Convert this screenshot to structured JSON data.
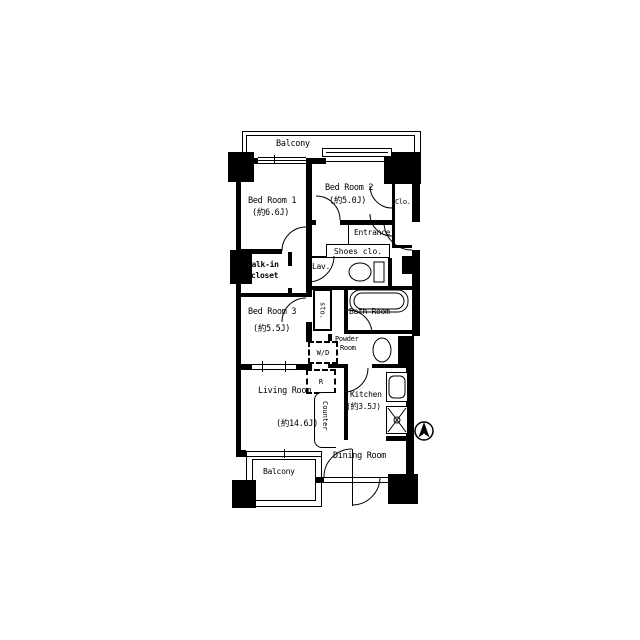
{
  "colors": {
    "walls": "#000000",
    "background": "#ffffff"
  },
  "floorplan": {
    "balcony_top": {
      "label": "Balcony"
    },
    "bedroom1": {
      "name": "Bed Room 1",
      "size": "(約6.6J)"
    },
    "bedroom2": {
      "name": "Bed Room 2",
      "size": "(約5.0J)"
    },
    "closet2": {
      "label": "Clo."
    },
    "entrance": {
      "label": "Entrance"
    },
    "shoes_closet": {
      "label": "Shoes clo."
    },
    "lavatory": {
      "label": "Lav."
    },
    "storage": {
      "label": "sto."
    },
    "bathroom": {
      "label": "Bath Room"
    },
    "powder_room": {
      "line1": "Powder",
      "line2": "Room"
    },
    "washer_dryer": {
      "label": "W/D"
    },
    "refrigerator": {
      "label": "R"
    },
    "walkin_closet": {
      "line1": "Walk-in",
      "line2": "closet"
    },
    "bedroom3": {
      "name": "Bed Room 3",
      "size": "(約5.5J)"
    },
    "living": {
      "name": "Living Room",
      "size": "(約14.6J)"
    },
    "kitchen": {
      "name": "Kitchen",
      "size": "(約3.5J)"
    },
    "counter": {
      "label": "Counter"
    },
    "dining": {
      "label": "Dining Room"
    },
    "balcony_bottom": {
      "label": "Balcony"
    }
  }
}
